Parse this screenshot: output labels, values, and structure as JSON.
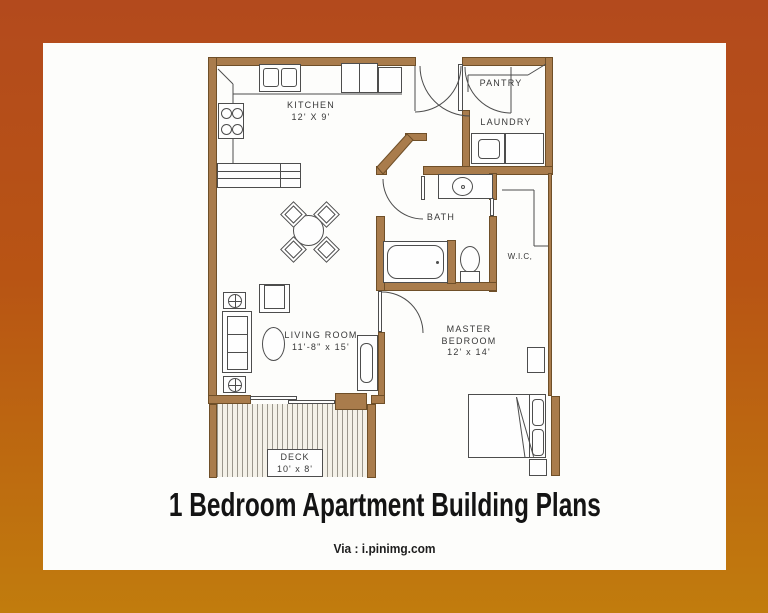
{
  "title": "1 Bedroom Apartment Building Plans",
  "attribution": "Via : i.pinimg.com",
  "colors": {
    "frame_gradient_top": "#b34a1d",
    "frame_gradient_bottom": "#c17c0d",
    "wall_fill": "#a97c4c",
    "wall_edge": "#6f4f28",
    "linework": "#4d4d4d",
    "canvas": "#fdfdfb"
  },
  "rooms": {
    "kitchen": {
      "name": "KITCHEN",
      "dims": "12' X 9'"
    },
    "pantry": {
      "name": "PANTRY"
    },
    "laundry": {
      "name": "LAUNDRY"
    },
    "bath": {
      "name": "BATH"
    },
    "wic": {
      "name": "W.I.C,"
    },
    "living": {
      "name": "LIVING ROOM",
      "dims": "11'-8\" x 15'"
    },
    "master": {
      "name_line1": "MASTER",
      "name_line2": "BEDROOM",
      "dims": "12' x 14'"
    },
    "deck": {
      "name": "DECK",
      "dims": "10' x 8'"
    }
  }
}
